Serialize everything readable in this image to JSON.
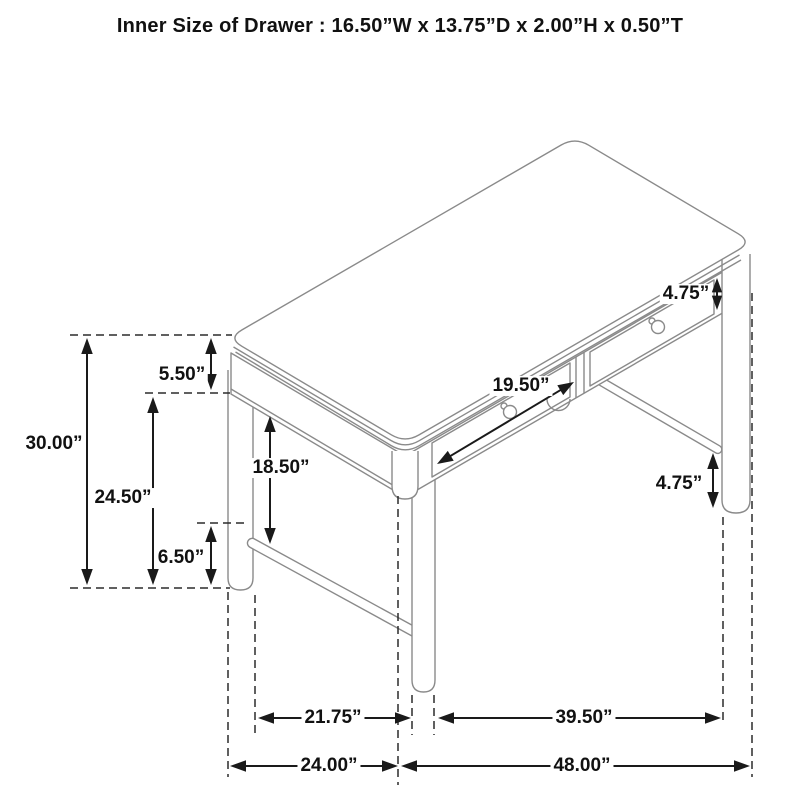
{
  "title": "Inner Size of Drawer : 16.50”W x 13.75”D x 2.00”H x 0.50”T",
  "colors": {
    "background": "#ffffff",
    "drawing_line": "#8a8a8a",
    "dashed_line": "#2b2b2b",
    "dimension_line": "#1a1a1a",
    "text": "#111111"
  },
  "desk": {
    "description": "isometric line drawing of a two-drawer writing desk",
    "drawer_count": 2
  },
  "dimensions": [
    {
      "id": "overall-height",
      "label": "30.00”",
      "type": "vertical",
      "x": 87,
      "y1": 338,
      "y2": 585,
      "label_x": 54,
      "label_y": 444
    },
    {
      "id": "floor-to-apron",
      "label": "24.50”",
      "type": "vertical",
      "x": 153,
      "y1": 397,
      "y2": 585,
      "label_x": 123,
      "label_y": 498
    },
    {
      "id": "top-apron-height",
      "label": "5.50”",
      "type": "vertical",
      "x": 211,
      "y1": 338,
      "y2": 390,
      "label_x": 182,
      "label_y": 375
    },
    {
      "id": "stretcher-height",
      "label": "6.50”",
      "type": "vertical",
      "x": 211,
      "y1": 526,
      "y2": 585,
      "label_x": 181,
      "label_y": 558
    },
    {
      "id": "apron-to-stretcher",
      "label": "18.50”",
      "type": "vertical",
      "x": 270,
      "y1": 416,
      "y2": 544,
      "label_x": 281,
      "label_y": 468
    },
    {
      "id": "drawer-front-width",
      "label": "19.50”",
      "type": "diagonal",
      "x1": 437,
      "y1": 464,
      "x2": 574,
      "y2": 382,
      "label_x": 521,
      "label_y": 386
    },
    {
      "id": "drawer-face-height",
      "label": "4.75”",
      "type": "vertical",
      "x": 717,
      "y1": 278,
      "y2": 310,
      "label_x": 686,
      "label_y": 294
    },
    {
      "id": "stretcher-to-floor",
      "label": "4.75”",
      "type": "vertical",
      "x": 713,
      "y1": 453,
      "y2": 508,
      "label_x": 679,
      "label_y": 484
    },
    {
      "id": "inner-leg-depth",
      "label": "21.75”",
      "type": "horizontal",
      "y": 718,
      "x1": 258,
      "x2": 411,
      "label_x": 333,
      "label_y": 718
    },
    {
      "id": "inner-leg-width",
      "label": "39.50”",
      "type": "horizontal",
      "y": 718,
      "x1": 438,
      "x2": 721,
      "label_x": 584,
      "label_y": 718
    },
    {
      "id": "overall-depth",
      "label": "24.00”",
      "type": "horizontal",
      "y": 766,
      "x1": 230,
      "x2": 398,
      "label_x": 329,
      "label_y": 766
    },
    {
      "id": "overall-width",
      "label": "48.00”",
      "type": "horizontal",
      "y": 766,
      "x1": 401,
      "x2": 750,
      "label_x": 582,
      "label_y": 766
    }
  ]
}
